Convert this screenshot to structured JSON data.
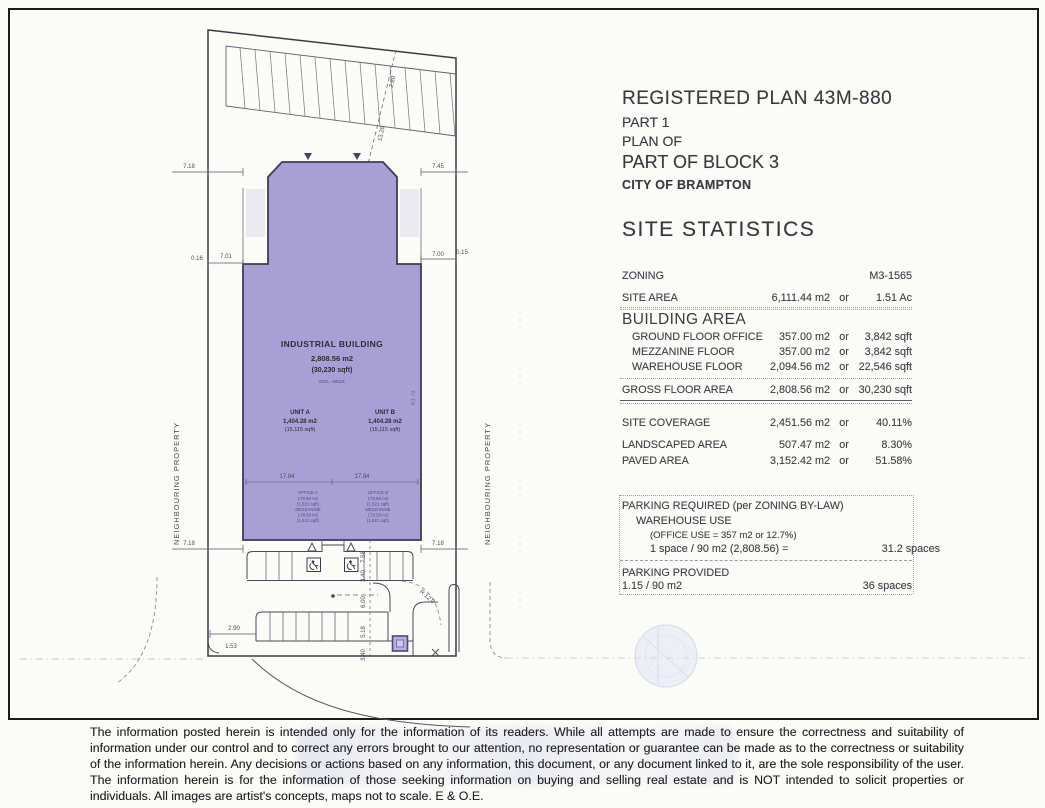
{
  "plan": {
    "neighbouring_left": "NEIGHBOURING PROPERTY",
    "neighbouring_right": "NEIGHBOURING PROPERTY",
    "building": {
      "name": "INDUSTRIAL BUILDING",
      "area_m2": "2,808.56 m2",
      "area_sqft": "(30,230 sqft)",
      "note": "INCL. MEZZ",
      "unit_a": {
        "name": "UNIT  A",
        "m2": "1,404.28 m2",
        "sqft": "(15,115 sqft)"
      },
      "unit_b": {
        "name": "UNIT  B",
        "m2": "1,404.28 m2",
        "sqft": "(15,115 sqft)"
      },
      "office_a": [
        "OFFICE A",
        "178.50 m2",
        "(1,921 sqft)",
        "MEZZANINE",
        "178.50 m2",
        "(1,921 sqft)"
      ],
      "office_b": [
        "OFFICE B",
        "178.50 m2",
        "(1,921 sqft)",
        "MEZZANINE",
        "178.50 m2",
        "(1,921 sqft)"
      ]
    },
    "dims": {
      "top_left": "7.18",
      "top_right": "7.45",
      "left_jog": "0.16",
      "left_strip": "7.01",
      "right_strip": "7.00",
      "right_jog": "0.15",
      "bottom_left": "7.18",
      "bottom_right": "7.18",
      "unit_a_width": "17.84",
      "unit_b_width": "17.84",
      "col_1": "7.58",
      "col_2": "3.40",
      "col_3": "6.00",
      "col_4": "5.18",
      "col_5": "3.40",
      "drive": "2.90",
      "corner": "1.53",
      "diag": "13.26",
      "diag_top": "2.80",
      "radius": "R 12.0",
      "depth": "43.78"
    }
  },
  "title_block": {
    "line1": "REGISTERED PLAN 43M-880",
    "line2": "PART 1",
    "line3": "PLAN OF",
    "line4": "PART OF BLOCK 3",
    "line5": "CITY OF BRAMPTON"
  },
  "stats": {
    "heading": "SITE STATISTICS",
    "zoning": {
      "label": "ZONING",
      "value": "M3-1565"
    },
    "site_area": {
      "label": "SITE AREA",
      "m2": "6,111.44 m2",
      "or": "or",
      "imp": "1.51 Ac"
    },
    "building_header": "BUILDING AREA",
    "building_rows": [
      {
        "label": "GROUND FLOOR OFFICE",
        "m2": "357.00 m2",
        "or": "or",
        "imp": "3,842 sqft"
      },
      {
        "label": "MEZZANINE FLOOR",
        "m2": "357.00 m2",
        "or": "or",
        "imp": "3,842 sqft"
      },
      {
        "label": "WAREHOUSE FLOOR",
        "m2": "2,094.56 m2",
        "or": "or",
        "imp": "22,546 sqft"
      }
    ],
    "gross": {
      "label": "GROSS FLOOR AREA",
      "m2": "2,808.56 m2",
      "or": "or",
      "imp": "30,230 sqft"
    },
    "coverage": {
      "label": "SITE COVERAGE",
      "m2": "2,451.56 m2",
      "or": "or",
      "imp": "40.11%"
    },
    "landscaped": {
      "label": "LANDSCAPED AREA",
      "m2": "507.47 m2",
      "or": "or",
      "imp": "8.30%"
    },
    "paved": {
      "label": "PAVED AREA",
      "m2": "3,152.42 m2",
      "or": "or",
      "imp": "51.58%"
    },
    "parking_required": "PARKING REQUIRED (per ZONING BY-LAW)",
    "warehouse_use": "WAREHOUSE USE",
    "office_note": "(OFFICE USE = 357 m2  or  12.7%)",
    "ratio_label": "1 space / 90 m2 (2,808.56) =",
    "ratio_value": "31.2 spaces",
    "provided_label": "PARKING PROVIDED",
    "provided_ratio": "1.15 / 90 m2",
    "provided_value": "36 spaces"
  },
  "disclaimer": "The information posted herein is intended only for the information of its readers.  While all attempts are made to ensure the correctness and suitability of information under our control and to correct any errors brought to our attention, no representation or guarantee can be made as to the correctness or suitability of the information herein.  Any decisions or actions based on any information, this document, or any document linked to it, are the sole responsibility of the user.  The information herein is for the information of those seeking information on buying and selling real estate and is NOT intended to solicit properties or individuals.  All images are artist's concepts, maps not to scale.  E & O.E."
}
